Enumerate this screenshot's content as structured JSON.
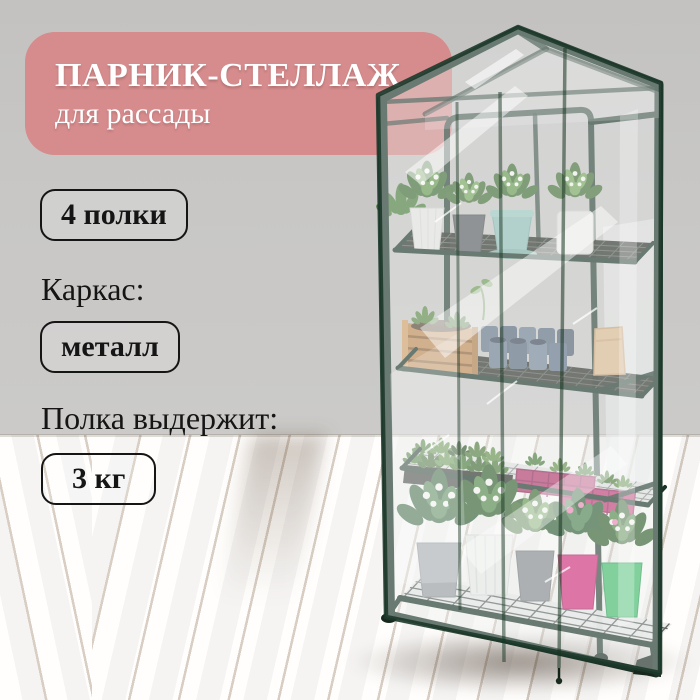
{
  "banner": {
    "title": "ПАРНИК-СТЕЛЛАЖ",
    "subtitle": "для рассады"
  },
  "specs": {
    "shelf_count": "4 полки",
    "frame_label": "Каркас:",
    "frame_material": "металл",
    "capacity_label": "Полка выдержит:",
    "capacity_value": "3 кг"
  },
  "colors": {
    "accent": "#d68b8c",
    "wall": "#c8c7c5",
    "floor": "#bb905c",
    "frame": "#1b3428",
    "ink": "#151515"
  }
}
